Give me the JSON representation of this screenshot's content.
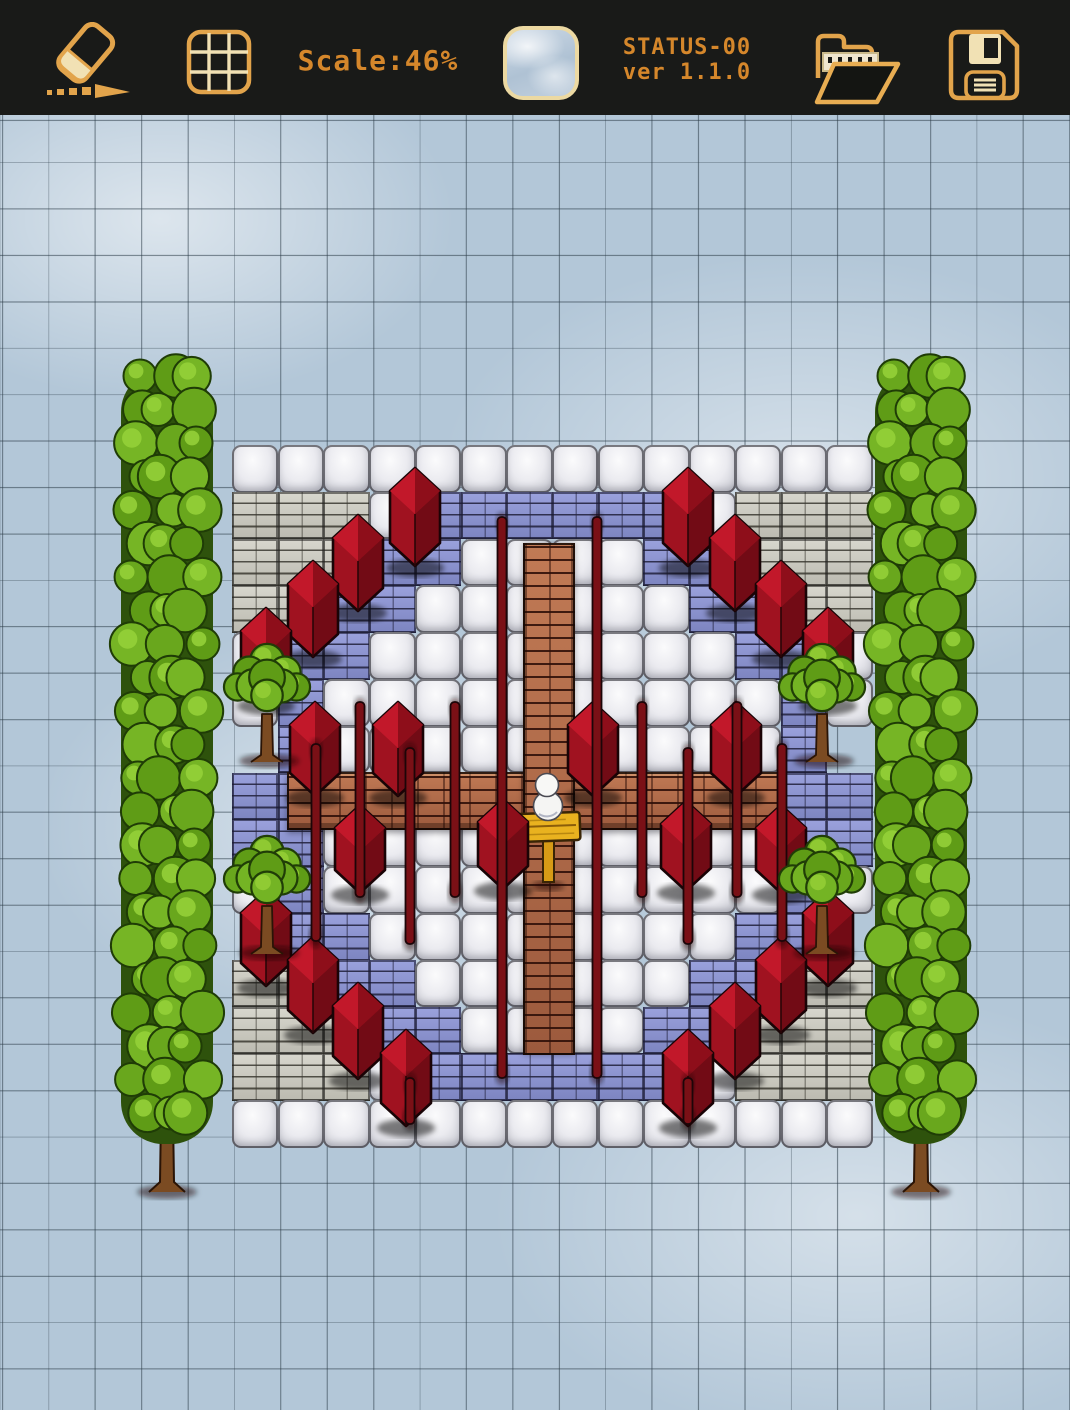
{
  "toolbar": {
    "scale_label": "Scale:46%",
    "status_line1": "STATUS-00",
    "status_line2": "ver 1.1.0",
    "tile_preview_texture": "ice",
    "tools": [
      "eraser",
      "grid-toggle",
      "tile-preview",
      "open-file",
      "save-file"
    ]
  },
  "colors": {
    "toolbar_bg": "#191a18",
    "accent_gold": "#e2a44b",
    "accent_cream": "#f1e1b4",
    "text_orange": "#d5872b",
    "ice": "#b3c7d8",
    "grid_line": "#2c3c48",
    "white_tile": "#ebebf0",
    "gray_brick": "#c9c8bf",
    "blue_brick": "#8c93ce",
    "path_brick": "#b0684a",
    "house_red": "#a01220",
    "pole_red": "#7a1016",
    "tree_green": "#6aa81e",
    "trunk_brown": "#7b4b22",
    "snow_white": "#f5f5f3",
    "sign_gold": "#e9b21f"
  },
  "canvas": {
    "top": 115,
    "grid": {
      "cell": 46.4,
      "offset_x": 2,
      "offset_y": 6
    },
    "plaza": {
      "x": 232,
      "y": 445,
      "cols": 14,
      "rows": 15,
      "cell_w": 45.714,
      "cell_h": 46.8,
      "legend": {
        "w": "white-stone-tile",
        "g": "gray-brick-tile",
        "b": "blue-brick-tile",
        "i": "ice-gap"
      },
      "tiles": [
        "wwwwwwwwwwwwww",
        "gggwbbbbbbwggg",
        "gggbbwwwwbbggg",
        "ggbbwwwwwwbbgg",
        "wbbwwwwwwwwbbw",
        "wbwwwwwwwwwwbw",
        "ibwwwwwwwwwwbi",
        "bbwwwwwwwwwwbb",
        "bbwwwwwwwwwwbb",
        "wbwwwwwwwwwwbw",
        "ibbwwwwwwwwbbi",
        "ggbbwwwwwwbbgg",
        "gggbbwwwwbbggg",
        "gggwbbbbbbwggg",
        "wwwwwwwwwwwwww"
      ]
    },
    "paths": {
      "horizontal": {
        "x": 287,
        "y": 772,
        "w": 493,
        "h": 58
      },
      "vertical": {
        "x": 523,
        "y": 543,
        "w": 52,
        "h": 512
      }
    },
    "houses": [
      [
        415,
        468,
        52
      ],
      [
        358,
        515,
        50
      ],
      [
        313,
        561,
        50
      ],
      [
        266,
        608,
        50
      ],
      [
        688,
        468,
        52
      ],
      [
        735,
        515,
        50
      ],
      [
        781,
        561,
        50
      ],
      [
        828,
        608,
        50
      ],
      [
        266,
        890,
        50
      ],
      [
        313,
        937,
        50
      ],
      [
        358,
        983,
        50
      ],
      [
        406,
        1030,
        50
      ],
      [
        828,
        890,
        50
      ],
      [
        781,
        937,
        50
      ],
      [
        735,
        983,
        50
      ],
      [
        688,
        1030,
        50
      ],
      [
        315,
        702,
        48
      ],
      [
        398,
        702,
        48
      ],
      [
        593,
        702,
        48
      ],
      [
        736,
        702,
        48
      ],
      [
        360,
        805,
        42
      ],
      [
        503,
        799,
        44
      ],
      [
        686,
        801,
        44
      ],
      [
        781,
        805,
        42
      ]
    ],
    "poles": [
      [
        502,
        517,
        1078
      ],
      [
        597,
        517,
        1078
      ],
      [
        360,
        702,
        897
      ],
      [
        455,
        702,
        897
      ],
      [
        642,
        702,
        897
      ],
      [
        737,
        702,
        897
      ],
      [
        316,
        744,
        941
      ],
      [
        410,
        748,
        944
      ],
      [
        688,
        748,
        944
      ],
      [
        782,
        744,
        941
      ],
      [
        410,
        1078,
        1124
      ],
      [
        688,
        1078,
        1124
      ]
    ],
    "trees": [
      [
        267,
        688
      ],
      [
        822,
        688
      ],
      [
        267,
        880
      ],
      [
        822,
        880
      ]
    ],
    "hedges": {
      "centers": [
        167,
        921
      ],
      "top": 362,
      "foliage_bottom": 1146,
      "trunk_bottom": 1190,
      "width": 92
    },
    "snowman": {
      "x": 547,
      "head_y": 785,
      "head_r": 11.5,
      "body_y": 806,
      "body_r": 14.5
    },
    "sign": {
      "x": 548,
      "plank": [
        517,
        813,
        63,
        28
      ],
      "post": [
        543,
        840,
        11,
        42
      ]
    }
  }
}
